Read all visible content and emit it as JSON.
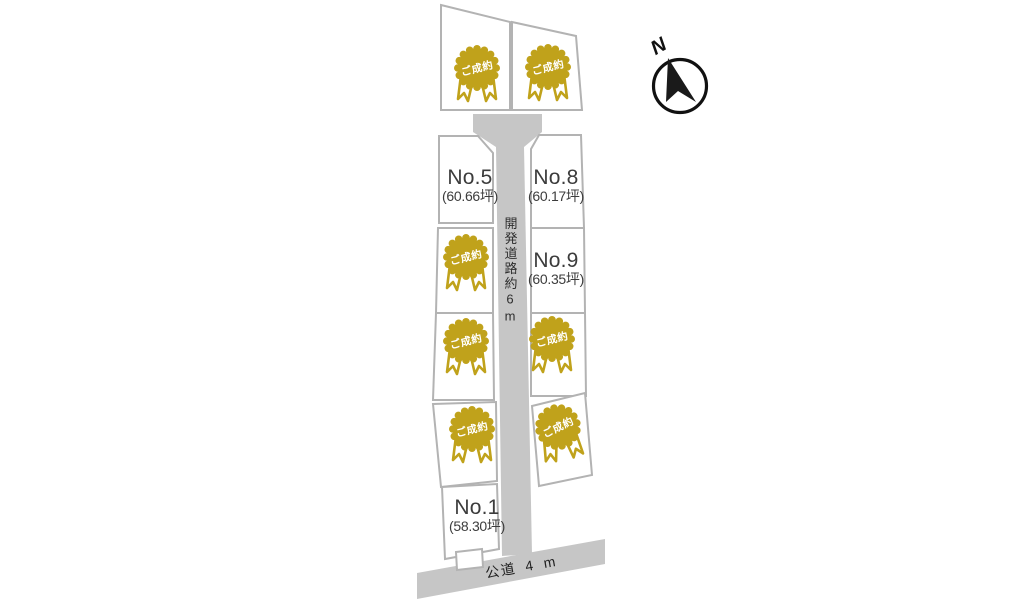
{
  "plan": {
    "compass": {
      "label": "N"
    },
    "main_road": {
      "label": "開発道路約6m"
    },
    "public_road": {
      "label": "公道 4 m"
    },
    "badge": {
      "label": "ご成約",
      "count": 7
    },
    "lots": {
      "no5": {
        "name": "No.5",
        "area": "(60.66坪)"
      },
      "no8": {
        "name": "No.8",
        "area": "(60.17坪)"
      },
      "no9": {
        "name": "No.9",
        "area": "(60.35坪)"
      },
      "no1": {
        "name": "No.1",
        "area": "(58.30坪)"
      }
    },
    "colors": {
      "lot_line": "#b3b3b3",
      "road_fill": "#c6c6c6",
      "badge_gold": "#c0a21b",
      "label_text": "#3c3c3c"
    }
  }
}
